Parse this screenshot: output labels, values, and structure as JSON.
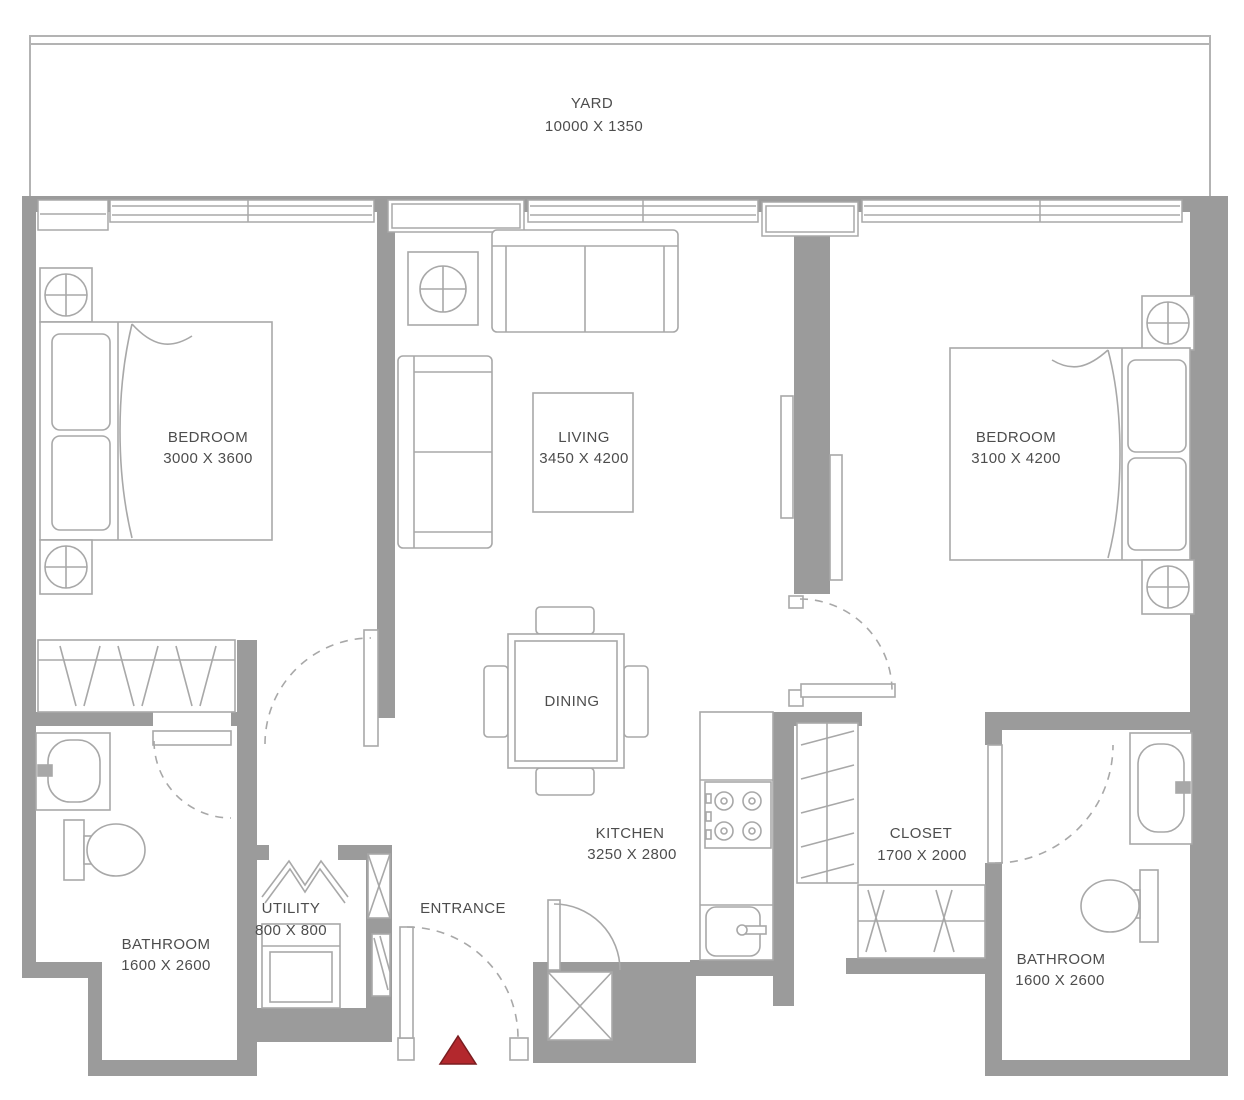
{
  "rooms": {
    "yard": {
      "name": "YARD",
      "dims": "10000 X 1350"
    },
    "bedroom1": {
      "name": "BEDROOM",
      "dims": "3000 X 3600"
    },
    "living": {
      "name": "LIVING",
      "dims": "3450 X 4200"
    },
    "bedroom2": {
      "name": "BEDROOM",
      "dims": "3100 X 4200"
    },
    "dining": {
      "name": "DINING"
    },
    "kitchen": {
      "name": "KITCHEN",
      "dims": "3250 X 2800"
    },
    "closet": {
      "name": "CLOSET",
      "dims": "1700 X 2000"
    },
    "bathroom1": {
      "name": "BATHROOM",
      "dims": "1600 X 2600"
    },
    "utility": {
      "name": "UTILITY",
      "dims": "800 X 800"
    },
    "entrance": {
      "name": "ENTRANCE"
    },
    "bathroom2": {
      "name": "BATHROOM",
      "dims": "1600 X 2600"
    }
  },
  "colors": {
    "wall": "#9b9b9b",
    "line": "#a8a8a8",
    "text": "#4d4d4d",
    "entrance_marker": "#b3282d"
  }
}
